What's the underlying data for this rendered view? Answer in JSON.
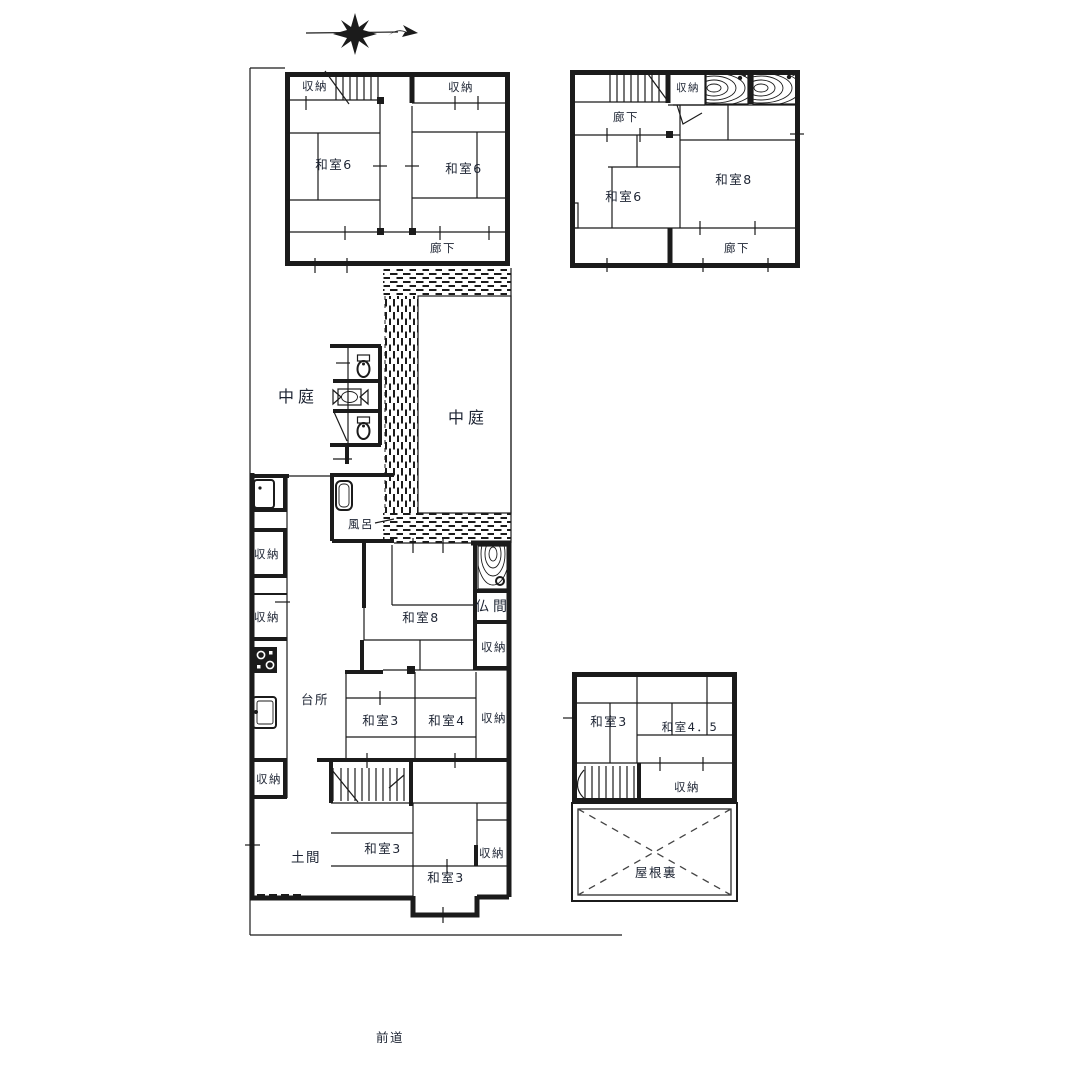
{
  "canvas": {
    "background": "#ffffff",
    "line_color": "#1b1b1b",
    "text_color": "#1d2433"
  },
  "site": {
    "road_label": "前道"
  },
  "icons": {
    "compass": "north-arrow",
    "toilet": "toilet-plan-symbol",
    "washbasin": "washbasin-symbol",
    "bathtub": "bathtub-symbol",
    "stove": "stove-symbol",
    "kitchen_sink": "kitchen-sink-symbol",
    "stairs": "staircase-symbol",
    "veranda": "hatched-walkway",
    "wood_floor": "wood-grain-panel",
    "attic_cross": "dashed-x-roof-space"
  },
  "labels": {
    "a_closet_l": "収納",
    "a_closet_r": "収納",
    "a_washitsu6_l": "和室6",
    "a_washitsu6_r": "和室6",
    "a_corridor": "廊下",
    "b_corridor_top": "廊下",
    "b_closet": "収納",
    "b_washitsu6": "和室6",
    "b_washitsu8": "和室8",
    "b_corridor_bottom": "廊下",
    "courtyard_left": "中庭",
    "courtyard_right": "中庭",
    "bath": "風呂",
    "closet_w1": "収納",
    "closet_w2": "収納",
    "closet_w3": "収納",
    "washitsu8": "和室8",
    "butsuma": "仏間",
    "closet_e1": "収納",
    "kitchen": "台所",
    "washitsu3_a": "和室3",
    "washitsu4": "和室4",
    "closet_e2": "収納",
    "doma": "土間",
    "washitsu3_b": "和室3",
    "washitsu3_c": "和室3",
    "closet_e3": "収納",
    "c_washitsu3": "和室3",
    "c_washitsu45": "和室4．5",
    "c_closet": "収納",
    "attic": "屋根裏",
    "road": "前道"
  }
}
